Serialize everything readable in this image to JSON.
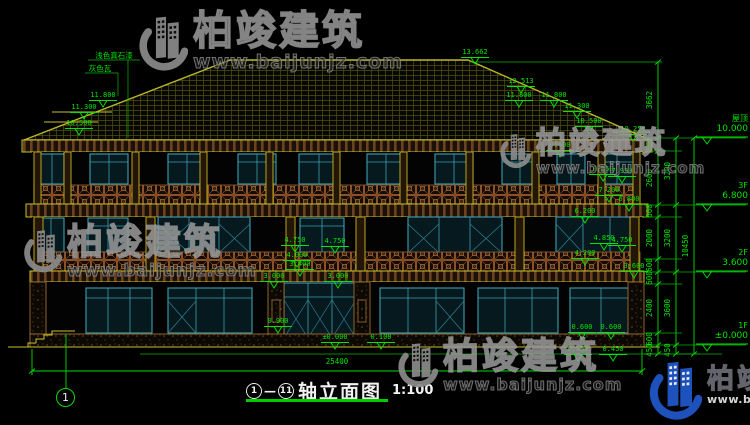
{
  "drawing_title": {
    "axis_start": "1",
    "separator": "—",
    "axis_end": "11",
    "name": "轴立面图",
    "scale": "1:100"
  },
  "axis_bubble": {
    "label": "1"
  },
  "watermark": {
    "brand": "柏竣建筑",
    "url": "www.baijunjz.com"
  },
  "colors": {
    "dimension_green": "#00dc00",
    "line_yellow": "#c9c12a",
    "window_teal": "#3f9fb0",
    "railing_brown": "#8a5226",
    "watermark_blue": "#2058cc"
  },
  "drawing": {
    "levels": [
      {
        "label": "屋顶",
        "value": "10.000"
      },
      {
        "label": "3F",
        "value": "6.800"
      },
      {
        "label": "2F",
        "value": "3.600"
      },
      {
        "label": "1F",
        "value": "±0.000"
      }
    ],
    "dim_chains": {
      "outer": [
        {
          "v": "3662",
          "x": 650,
          "y": 100
        },
        {
          "v": "600",
          "x": 650,
          "y": 144
        },
        {
          "v": "2600",
          "x": 650,
          "y": 178
        },
        {
          "v": "600",
          "x": 650,
          "y": 211
        },
        {
          "v": "2000",
          "x": 650,
          "y": 238
        },
        {
          "v": "600",
          "x": 650,
          "y": 265
        },
        {
          "v": "600",
          "x": 650,
          "y": 278
        },
        {
          "v": "2400",
          "x": 650,
          "y": 308
        },
        {
          "v": "600",
          "x": 650,
          "y": 339
        },
        {
          "v": "450",
          "x": 650,
          "y": 350
        }
      ],
      "middle": [
        {
          "v": "3200",
          "x": 668,
          "y": 171
        },
        {
          "v": "3200",
          "x": 668,
          "y": 238
        },
        {
          "v": "3600",
          "x": 668,
          "y": 308
        },
        {
          "v": "450",
          "x": 668,
          "y": 350
        }
      ],
      "overall": [
        {
          "v": "10450",
          "x": 686,
          "y": 246
        }
      ]
    },
    "level_marks": [
      {
        "v": "13.662",
        "x": 475,
        "y": 49
      },
      {
        "v": "12.513",
        "x": 521,
        "y": 78
      },
      {
        "v": "11.800",
        "x": 519,
        "y": 92
      },
      {
        "v": "11.800",
        "x": 554,
        "y": 92
      },
      {
        "v": "11.300",
        "x": 577,
        "y": 103
      },
      {
        "v": "10.500",
        "x": 589,
        "y": 118
      },
      {
        "v": "10.250",
        "x": 633,
        "y": 126
      },
      {
        "v": "9.400",
        "x": 560,
        "y": 142
      },
      {
        "v": "11.800",
        "x": 103,
        "y": 92
      },
      {
        "v": "11.300",
        "x": 84,
        "y": 104
      },
      {
        "v": "10.500",
        "x": 79,
        "y": 120
      },
      {
        "v": "8.050",
        "x": 603,
        "y": 166
      },
      {
        "v": "7.950",
        "x": 622,
        "y": 168
      },
      {
        "v": "7.200",
        "x": 609,
        "y": 187
      },
      {
        "v": "6.800",
        "x": 629,
        "y": 196
      },
      {
        "v": "6.200",
        "x": 585,
        "y": 208
      },
      {
        "v": "4.850",
        "x": 604,
        "y": 235
      },
      {
        "v": "4.750",
        "x": 622,
        "y": 237
      },
      {
        "v": "4.200",
        "x": 585,
        "y": 250
      },
      {
        "v": "3.600",
        "x": 634,
        "y": 263
      },
      {
        "v": "4.750",
        "x": 295,
        "y": 237
      },
      {
        "v": "4.750",
        "x": 335,
        "y": 238
      },
      {
        "v": "4.000",
        "x": 297,
        "y": 252
      },
      {
        "v": "3.400",
        "x": 300,
        "y": 261
      },
      {
        "v": "3.000",
        "x": 274,
        "y": 273
      },
      {
        "v": "3.000",
        "x": 338,
        "y": 273
      },
      {
        "v": "0.900",
        "x": 278,
        "y": 318
      },
      {
        "v": "±0.000",
        "x": 335,
        "y": 334
      },
      {
        "v": "0.100",
        "x": 381,
        "y": 334
      },
      {
        "v": "0.600",
        "x": 582,
        "y": 324
      },
      {
        "v": "0.600",
        "x": 611,
        "y": 324
      },
      {
        "v": "0.450",
        "x": 578,
        "y": 346
      },
      {
        "v": "0.450",
        "x": 613,
        "y": 346
      }
    ],
    "plain_texts": [
      {
        "v": "25400",
        "x": 337,
        "y": 358
      },
      {
        "v": "浅色真石漆",
        "x": 114,
        "y": 52
      },
      {
        "v": "灰色瓦",
        "x": 100,
        "y": 65
      }
    ]
  }
}
